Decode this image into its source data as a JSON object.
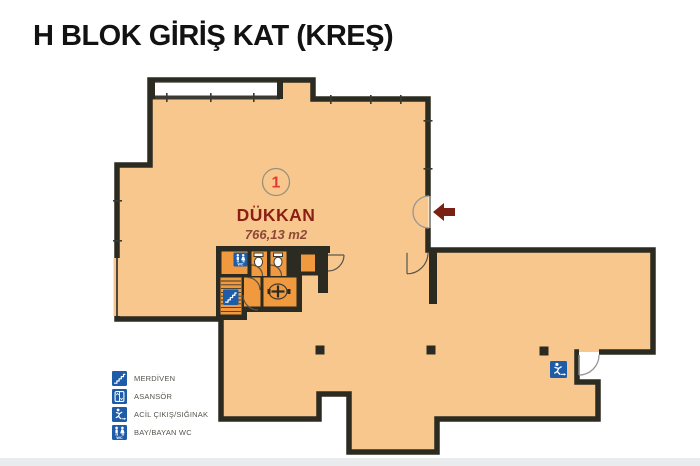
{
  "title": "H BLOK GİRİŞ KAT (KREŞ)",
  "plan": {
    "unit": {
      "number": "1",
      "name": "DÜKKAN",
      "area": "766,13 m2"
    }
  },
  "icons": {
    "wc_label": "WC"
  },
  "legend": {
    "items": [
      {
        "icon": "stairs-icon",
        "label": "MERDİVEN"
      },
      {
        "icon": "elevator-icon",
        "label": "ASANSÖR"
      },
      {
        "icon": "emergency-exit-icon",
        "label": "ACİL ÇIKIŞ/SIĞINAK"
      },
      {
        "icon": "wc-icon",
        "label": "BAY/BAYAN WC"
      }
    ]
  },
  "colors": {
    "floor": "#f8c78e",
    "core_floor": "#f0993e",
    "wall": "#2b2b22",
    "icon_blue": "#1e5ca8",
    "arrow": "#7b2015",
    "unit_number": "#e23b34",
    "unit_name": "#8c1f15",
    "unit_area": "#8d4936",
    "legend_text": "#55554e",
    "footer_band": "#e9ebed",
    "title_color": "#121212"
  }
}
